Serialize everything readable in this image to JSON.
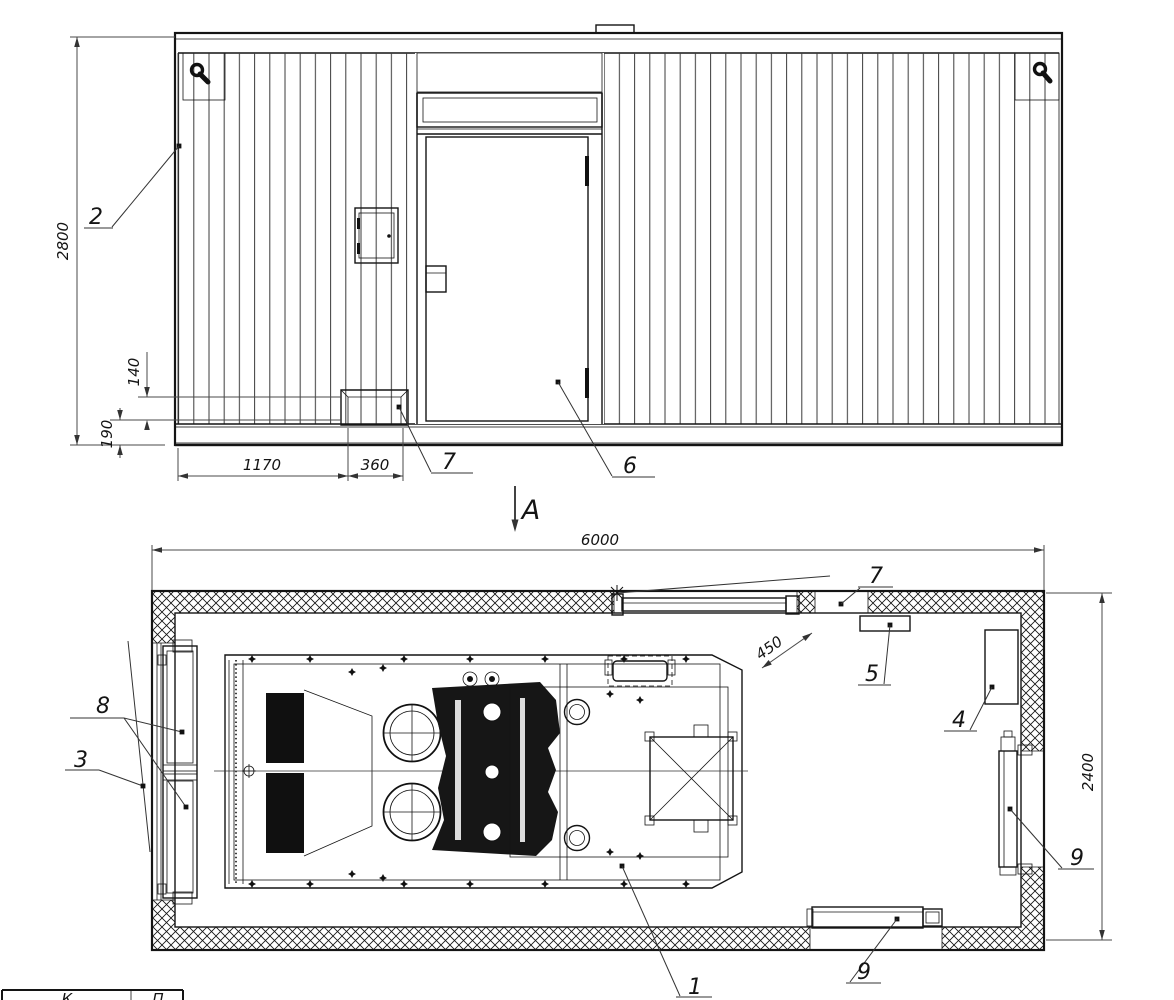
{
  "colors": {
    "ink": "#141414",
    "dim_line": "#4a4a4a"
  },
  "labels": {
    "section_arrow": "А",
    "elevation": {
      "dim_height": "2800",
      "dim_step_top": "140",
      "dim_base": "190",
      "dim_w1": "1170",
      "dim_w2": "360",
      "callout_wall_panel": "2",
      "callout_step": "7",
      "callout_door": "6"
    },
    "plan": {
      "dim_length": "6000",
      "dim_width": "2400",
      "dim_door_clear": "450",
      "callout_unit": "1",
      "callout_louver_upper": "8",
      "callout_louver_lower": "3",
      "callout_cabinet": "4",
      "callout_box": "5",
      "callout_step": "7",
      "callout_radiator_side": "9",
      "callout_radiator_rear": "9"
    },
    "title_block": {
      "col1": "К",
      "col2": "П"
    }
  }
}
